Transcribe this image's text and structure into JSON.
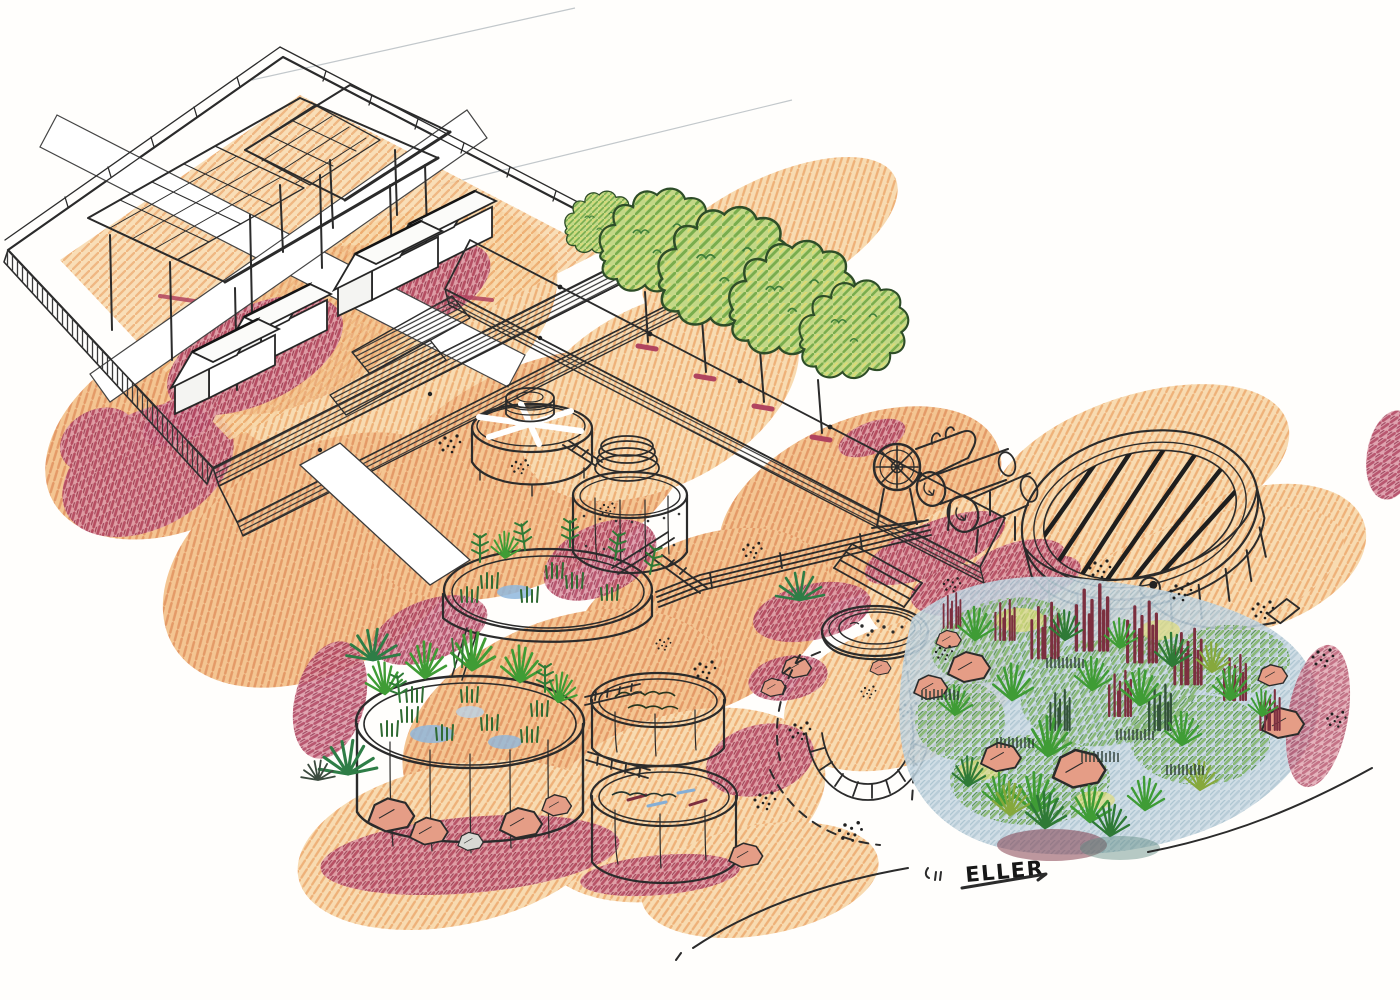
{
  "artwork": {
    "kind": "hand-drawn axonometric site sketch, ink and colored pencil",
    "signature": "ELLER"
  },
  "palette": {
    "paper": "#fffefc",
    "ink": "#2b2b2b",
    "sand": "#f8d8ab",
    "sand_deep": "#f3c089",
    "crimson": "#b0435f",
    "maroon": "#7c2f3f",
    "tree_green": "#79ad4d",
    "leaf_dark": "#2f7a36",
    "yellow_green": "#dfdc74",
    "water_blue": "#86b0d8",
    "wetland_blue": "#a3bccb",
    "algae_olive": "#5a7247",
    "teal_water": "#5e7f77",
    "media_brown": "#8a5a38",
    "rock_salmon": "#e59d86",
    "structure_white": "#ffffff"
  },
  "scene": {
    "elements": [
      {
        "name": "residential-platform",
        "desc": "raised deck with two gridded canopy roofs over four gabled cabins"
      },
      {
        "name": "tree-row",
        "desc": "row of round-canopy trees along an elevated walkway"
      },
      {
        "name": "walkways",
        "desc": "white raised walkways with hatched retaining walls and steps"
      },
      {
        "name": "treatment-tanks",
        "desc": "open-top tanks: trickling filter, dosing tank, two planted tanks, two algae ponds"
      },
      {
        "name": "machinery",
        "desc": "blower fan and rotating drum units with a pipe rack"
      },
      {
        "name": "covered-basin",
        "desc": "large oval basin covered by parallel beams over green water"
      },
      {
        "name": "fish-pool",
        "desc": "small round pool with blue water"
      },
      {
        "name": "paver-arc",
        "desc": "curved paver arc with dashed paths and scattered gravel"
      },
      {
        "name": "wetland-garden",
        "desc": "constructed wetland with grasses, maroon reeds and boulders"
      },
      {
        "name": "signature",
        "desc": "artist signature at lower right"
      }
    ]
  }
}
